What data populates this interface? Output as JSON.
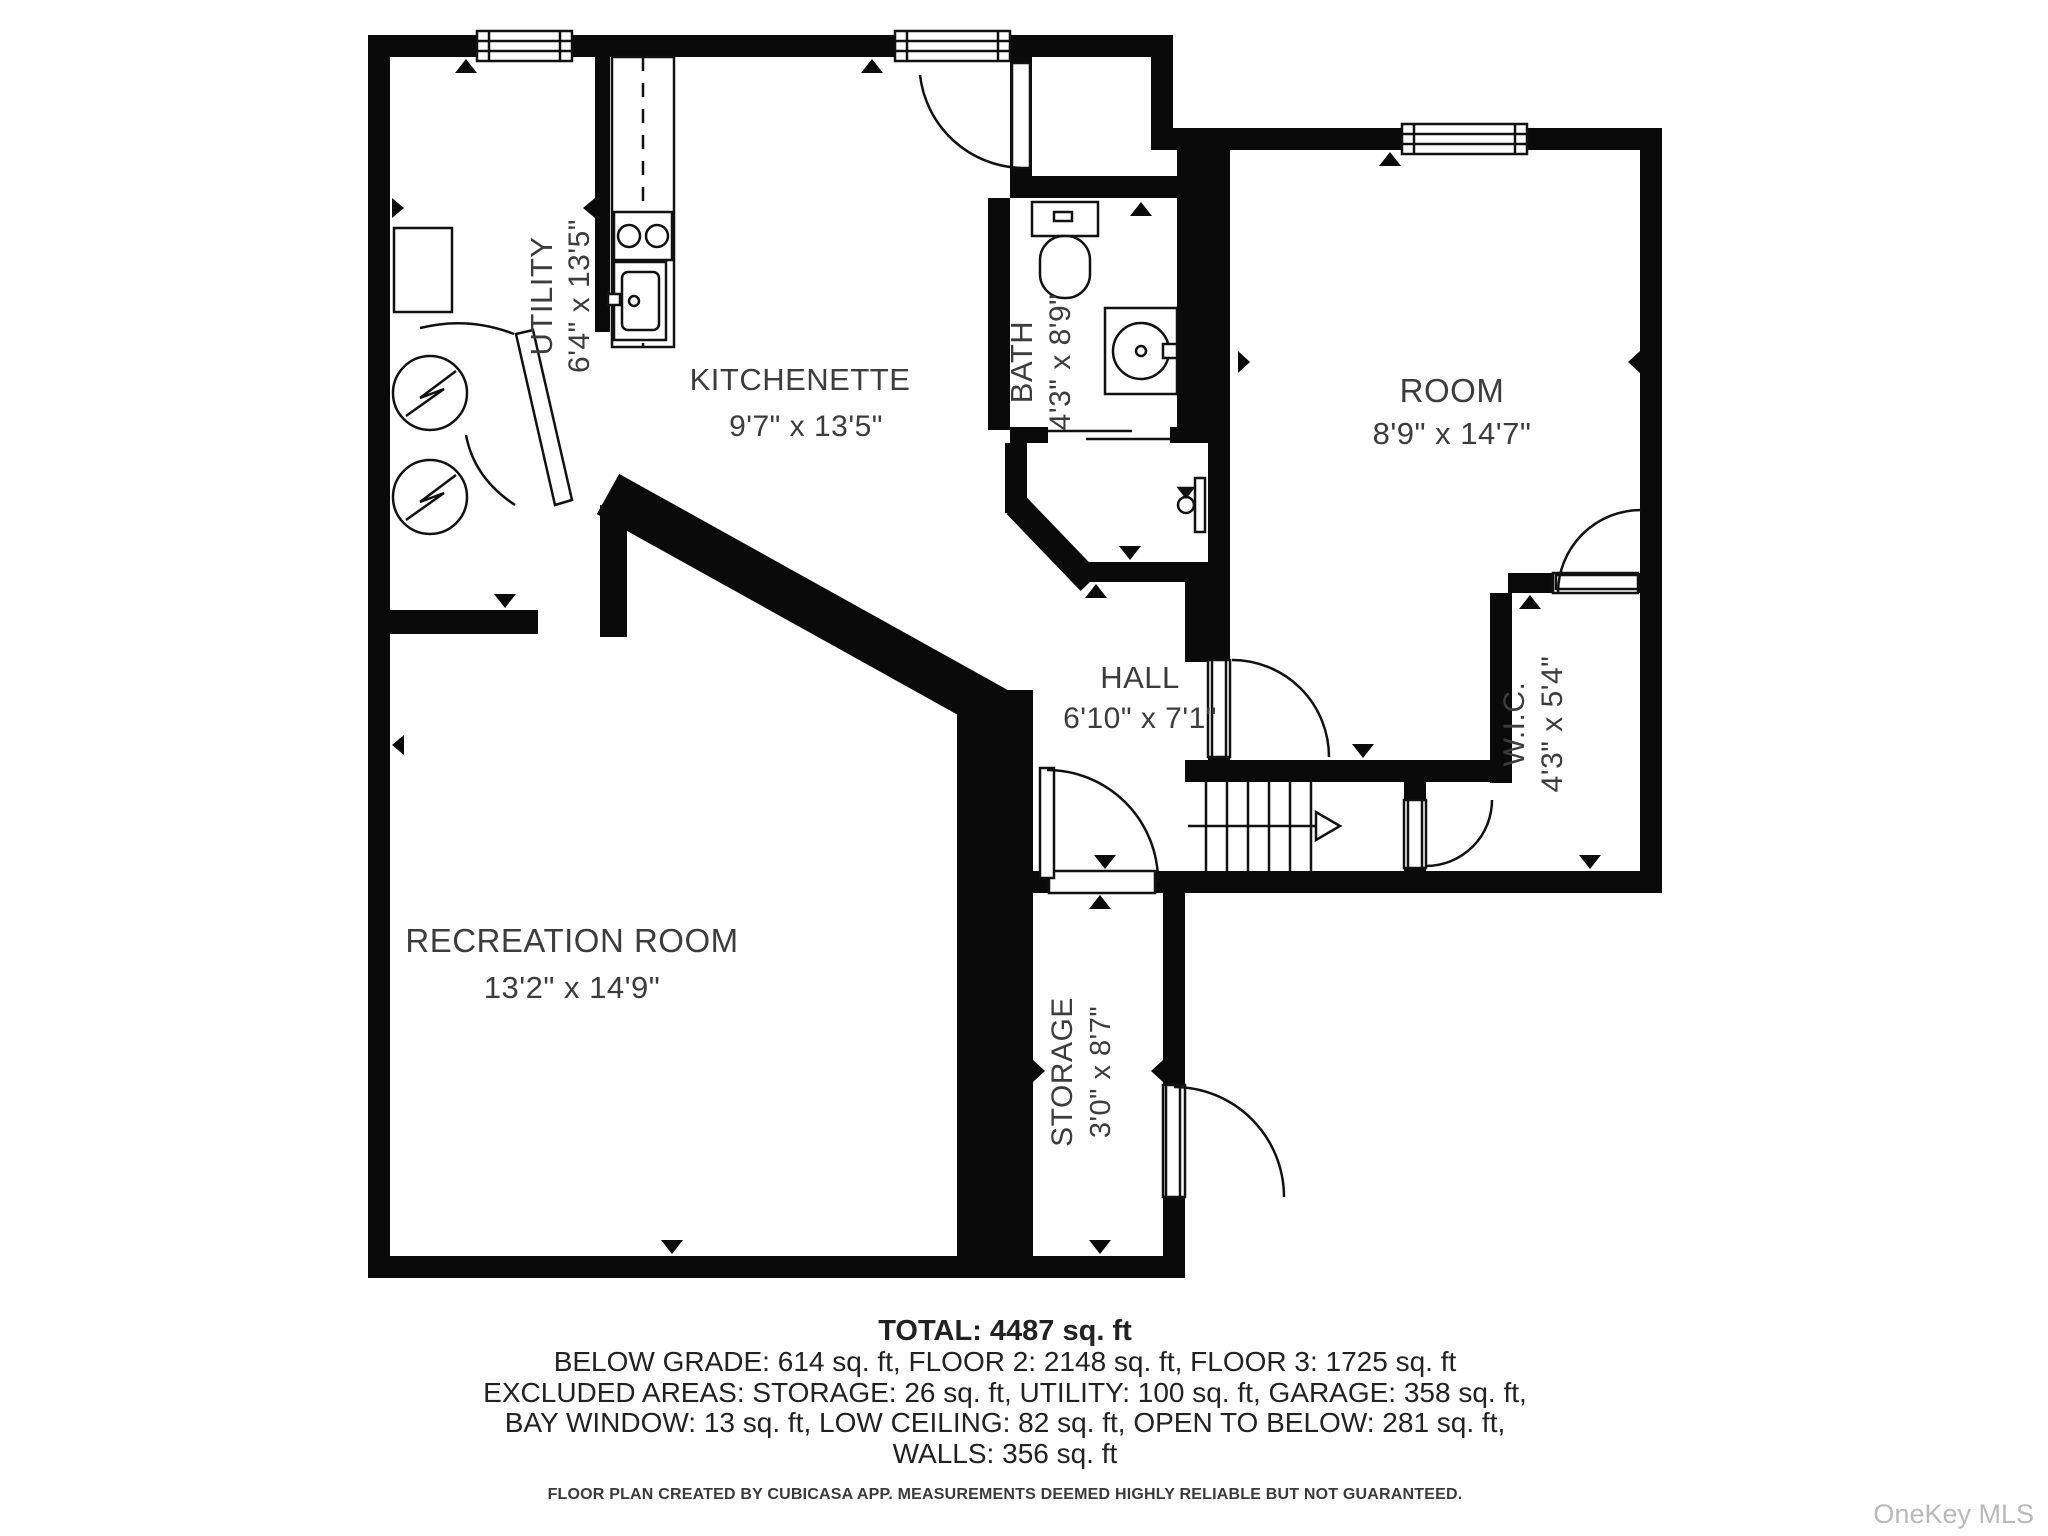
{
  "floor_plan": {
    "rooms": [
      {
        "name": "UTILITY",
        "dimensions": "6'4\" x 13'5\""
      },
      {
        "name": "KITCHENETTE",
        "dimensions": "9'7\" x 13'5\""
      },
      {
        "name": "BATH",
        "dimensions": "4'3\" x 8'9\""
      },
      {
        "name": "ROOM",
        "dimensions": "8'9\" x 14'7\""
      },
      {
        "name": "HALL",
        "dimensions": "6'10\" x 7'1\""
      },
      {
        "name": "W.I.C.",
        "dimensions": "4'3\" x 5'4\""
      },
      {
        "name": "RECREATION ROOM",
        "dimensions": "13'2\" x 14'9\""
      },
      {
        "name": "STORAGE",
        "dimensions": "3'0\" x 8'7\""
      }
    ],
    "summary": {
      "total": "TOTAL: 4487 sq. ft",
      "line2": "BELOW GRADE: 614 sq. ft, FLOOR 2: 2148 sq. ft, FLOOR 3: 1725 sq. ft",
      "line3": "EXCLUDED AREAS: STORAGE: 26 sq. ft, UTILITY: 100 sq. ft, GARAGE: 358 sq. ft,",
      "line4": "BAY WINDOW: 13 sq. ft, LOW CEILING: 82 sq. ft, OPEN TO BELOW: 281 sq. ft,",
      "line5": "WALLS: 356 sq. ft"
    },
    "disclaimer": "FLOOR PLAN CREATED BY CUBICASA APP. MEASUREMENTS DEEMED HIGHLY RELIABLE BUT NOT GUARANTEED.",
    "watermark": "OneKey MLS",
    "colors": {
      "wall": "#0a0a0a",
      "text": "#3c3c3c",
      "watermark": "#b9b9b9"
    }
  }
}
